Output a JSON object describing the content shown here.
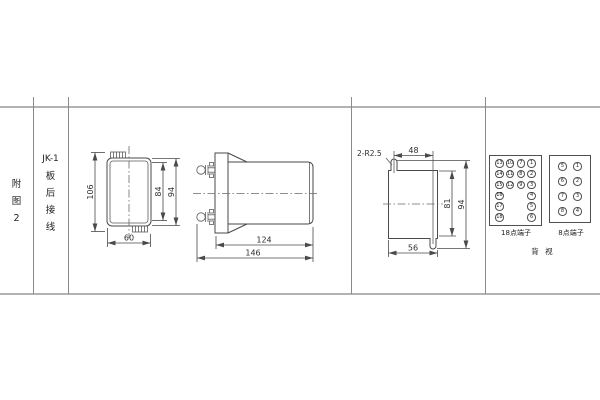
{
  "table": {
    "figure_label_chars": [
      "附",
      "图",
      "2"
    ],
    "model": "JK-1",
    "title_chars": [
      "板",
      "后",
      "接",
      "线"
    ]
  },
  "front_view": {
    "dim_height_overall": "106",
    "dim_height_inner": "84",
    "dim_height_case": "94",
    "dim_width": "60"
  },
  "side_view": {
    "dim_body_length": "124",
    "dim_total_length": "146"
  },
  "cutout_view": {
    "note_slots": "2-R2.5",
    "dim_slot_span": "48",
    "dim_height_inner": "81",
    "dim_height_overall": "94",
    "dim_width": "56"
  },
  "terminals": {
    "block18": {
      "label": "18点端子",
      "rows": [
        [
          "13",
          "10",
          "7",
          "1"
        ],
        [
          "14",
          "11",
          "8",
          "2"
        ],
        [
          "15",
          "12",
          "9",
          "3"
        ],
        [
          "16",
          null,
          null,
          "4"
        ],
        [
          "17",
          null,
          null,
          "5"
        ],
        [
          "18",
          null,
          null,
          "6"
        ]
      ]
    },
    "block8": {
      "label": "8点端子",
      "rows": [
        [
          "5",
          "1"
        ],
        [
          "6",
          "2"
        ],
        [
          "7",
          "3"
        ],
        [
          "8",
          "4"
        ]
      ]
    },
    "view_label": "背 视"
  },
  "colors": {
    "drawing_line": "#4a4a4a",
    "table_border": "#b2b2b2",
    "column_divider": "#8a8a8a",
    "text": "#2e2e2e"
  }
}
